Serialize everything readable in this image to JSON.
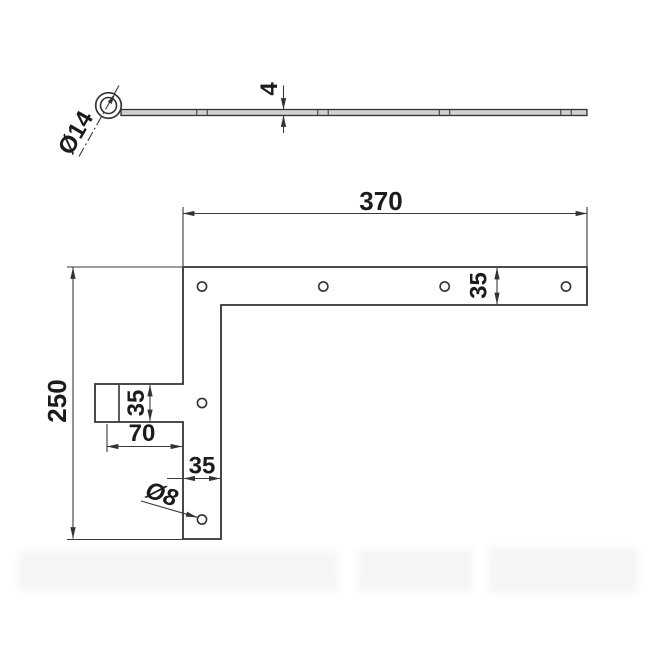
{
  "side_view": {
    "eye_diameter": "Ø14",
    "thickness": "4"
  },
  "front_view": {
    "length": "370",
    "height": "250",
    "bar_width": "35",
    "tab_height": "35",
    "leg_width": "35",
    "eye_offset": "70",
    "hole_diameter": "Ø8"
  },
  "colors": {
    "background": "#ffffff",
    "line": "#333333",
    "dim_line": "#3a3a3a",
    "text": "#1b1b1b",
    "strip_fill": "#d0d0d0"
  }
}
